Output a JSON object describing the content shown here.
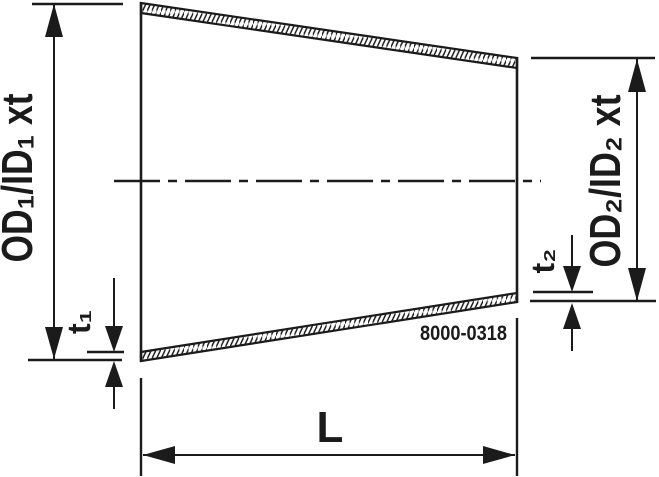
{
  "drawing": {
    "title": "Concentric reducer dimension drawing",
    "code": "8000-0318",
    "labels": {
      "od1": "OD₁/ID₁ xt",
      "od2": "OD₂/ID₂ xt",
      "t1": "t₁",
      "t2": "t₂",
      "length": "L"
    },
    "colors": {
      "ink": "#1b1b1b",
      "background": "#ffffff"
    },
    "canvas": {
      "width": 659,
      "height": 477
    }
  }
}
